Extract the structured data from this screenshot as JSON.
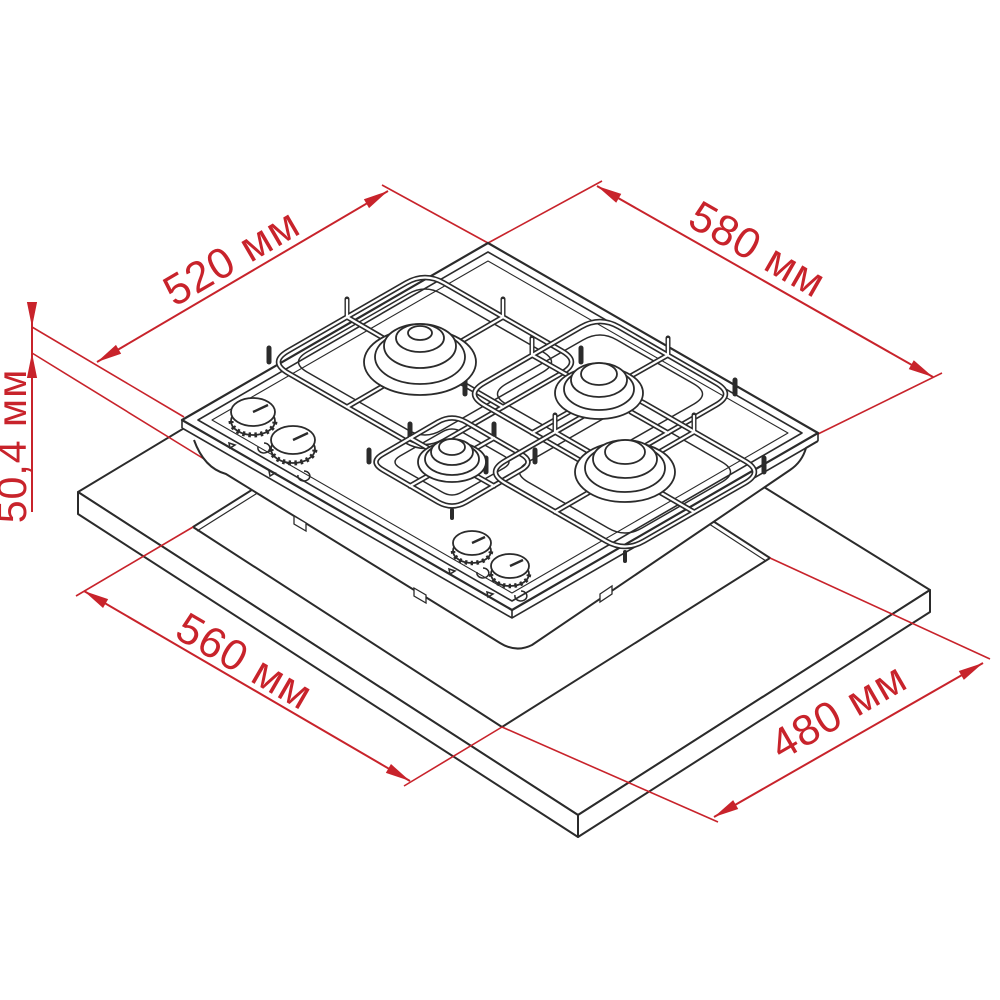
{
  "diagram": {
    "kind": "installation-dimension-drawing",
    "subject": "four-burner gas hob above countertop cutout",
    "unit": "мм",
    "dimensions": [
      {
        "id": "hob-depth",
        "label": "520 мм",
        "value": 520,
        "orientation_deg": -30
      },
      {
        "id": "hob-width",
        "label": "580 мм",
        "value": 580,
        "orientation_deg": 30
      },
      {
        "id": "hob-height",
        "label": "50,4 мм",
        "value": 50.4,
        "orientation_deg": -90
      },
      {
        "id": "cutout-width",
        "label": "560 мм",
        "value": 560,
        "orientation_deg": 30
      },
      {
        "id": "cutout-depth",
        "label": "480 мм",
        "value": 480,
        "orientation_deg": -30
      }
    ],
    "colors": {
      "dimension_red": "#c8232b",
      "drawing_line": "#2b2b2b",
      "background": "#ffffff"
    }
  }
}
